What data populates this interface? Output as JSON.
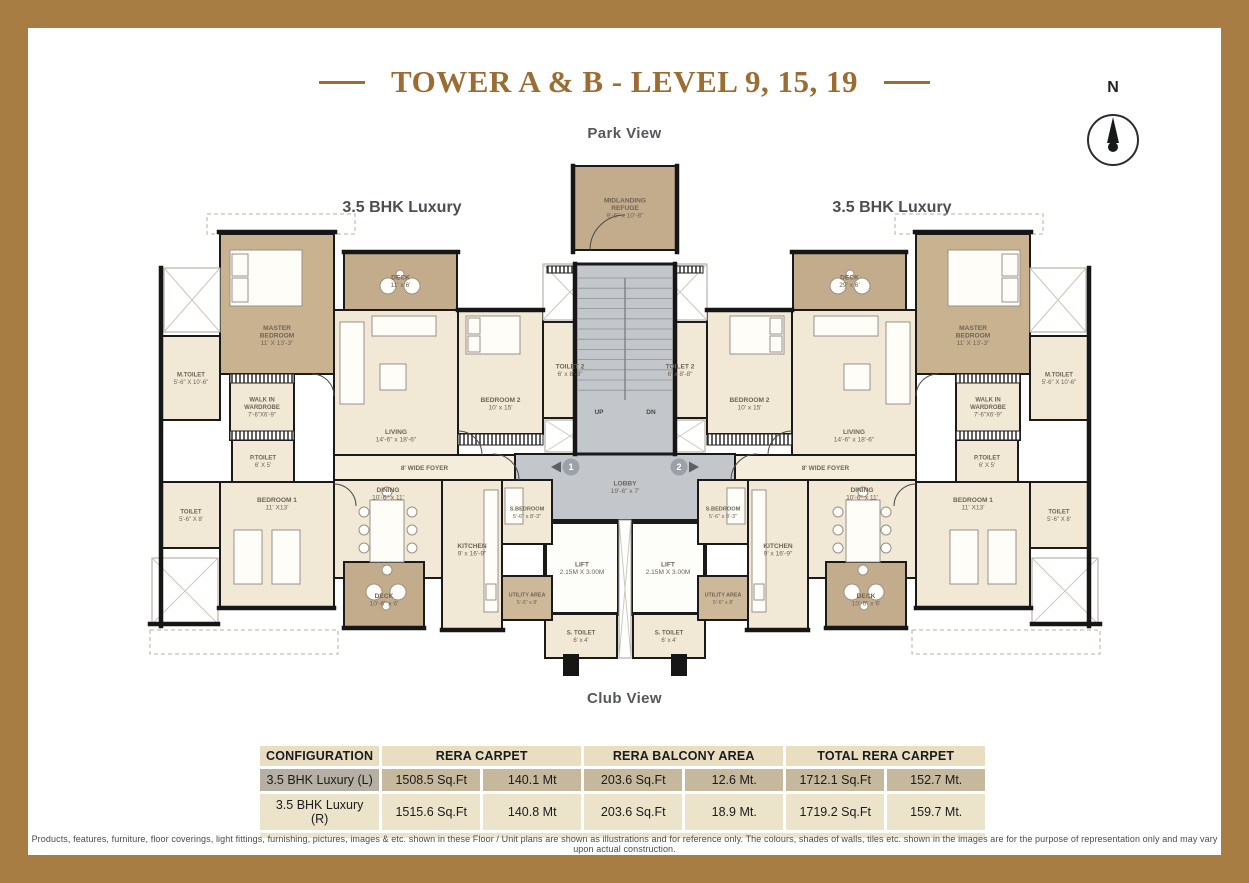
{
  "page": {
    "title": "TOWER A & B - LEVEL 9, 15, 19",
    "top_label": "Park View",
    "bottom_label": "Club View",
    "unit_label_left": "3.5 BHK Luxury",
    "unit_label_right": "3.5 BHK Luxury",
    "compass_letter": "N"
  },
  "colors": {
    "border": "#a87d44",
    "title": "#9c6d33",
    "cream": "#f1e8d5",
    "deck": "#c3ac8c",
    "master": "#c9b290",
    "gray": "#c3c7cb",
    "white": "#fdfdfa",
    "foyer": "#f4eddc",
    "deck_light": "#cdb89a",
    "wall": "#161616",
    "room_text": "#6f6455",
    "table_header_bg": "#e9dec1",
    "table_row1_bg": "#c5b89c",
    "table_row2_bg": "#ece3cb"
  },
  "floor_plan": {
    "rooms": {
      "refuge": {
        "lines": [
          "MIDLANDING",
          "REFUGE",
          "9'-6\" x 10'-8\""
        ]
      },
      "lobby": {
        "lines": [
          "LOBBY",
          "19'-6\" x 7'"
        ]
      },
      "lift": {
        "lines": [
          "LIFT",
          "2.15M X 3.00M"
        ]
      },
      "toilet2": {
        "lines": [
          "TOILET 2",
          "6' x 8'-8\""
        ]
      },
      "s_toilet": {
        "lines": [
          "S. TOILET",
          "6' x 4'"
        ]
      },
      "master_bedroom": {
        "lines": [
          "MASTER",
          "BEDROOM",
          "11' X 13'-3\""
        ]
      },
      "m_toilet": {
        "lines": [
          "M.TOILET",
          "5'-6\" X 10'-6\""
        ]
      },
      "walk_in_wardrobe": {
        "lines": [
          "WALK IN",
          "WARDROBE",
          "7'-6\"X6'-9\""
        ]
      },
      "p_toilet": {
        "lines": [
          "P.TOILET",
          "6' X 5'"
        ]
      },
      "toilet": {
        "lines": [
          "TOILET",
          "5'-6\" X 8'"
        ]
      },
      "bedroom1": {
        "lines": [
          "BEDROOM 1",
          "11' X13'"
        ]
      },
      "deck_top_left": {
        "lines": [
          "DECK",
          "11' x 6'"
        ]
      },
      "deck_top_right": {
        "lines": [
          "DECK",
          "29' x 6'"
        ]
      },
      "living": {
        "lines": [
          "LIVING",
          "14'-6\" x 18'-6\""
        ]
      },
      "bedroom2": {
        "lines": [
          "BEDROOM 2",
          "10' x 15'"
        ]
      },
      "foyer": {
        "lines": [
          "8' WIDE FOYER"
        ]
      },
      "dining": {
        "lines": [
          "DINING",
          "10'-6\" x 11'"
        ]
      },
      "kitchen": {
        "lines": [
          "KITCHEN",
          "9' x 16'-9\""
        ]
      },
      "deck_bottom": {
        "lines": [
          "DECK",
          "10'-6\" x 6'"
        ]
      },
      "utility": {
        "lines": [
          "UTILITY AREA",
          "5'-6\" x 8'"
        ]
      },
      "s_bedroom": {
        "lines": [
          "S.BEDROOM",
          "5'-6\" x 8'-3\""
        ]
      }
    },
    "stair_up": "UP",
    "stair_dn": "DN",
    "marker_left": "1",
    "marker_right": "2"
  },
  "table": {
    "headers": [
      "CONFIGURATION",
      "RERA CARPET",
      "RERA BALCONY AREA",
      "TOTAL RERA CARPET"
    ],
    "rows": [
      [
        "3.5 BHK Luxury (L)",
        "1508.5 Sq.Ft",
        "140.1 Mt",
        "203.6 Sq.Ft",
        "12.6 Mt.",
        "1712.1 Sq.Ft",
        "152.7 Mt."
      ],
      [
        "3.5 BHK Luxury (R)",
        "1515.6 Sq.Ft",
        "140.8 Mt",
        "203.6 Sq.Ft",
        "18.9 Mt.",
        "1719.2 Sq.Ft",
        "159.7 Mt."
      ]
    ]
  },
  "disclaimer": "Products, features, furniture, floor coverings, light fittings, furnishing, pictures, images & etc. shown in these Floor / Unit plans are shown as illustrations and for reference only. The colours, shades of walls, tiles etc. shown in the images are for the purpose of representation only and may vary upon actual construction."
}
